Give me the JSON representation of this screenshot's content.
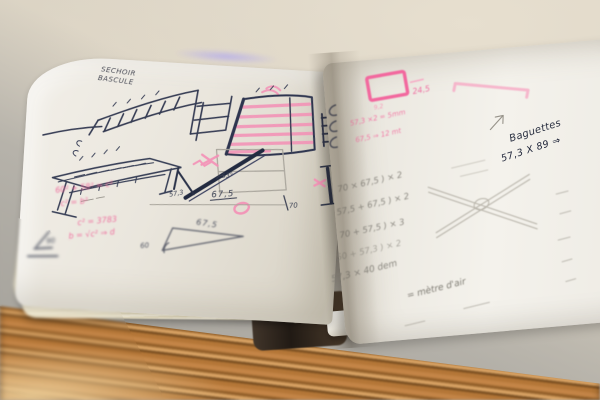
{
  "scene": {
    "subject": "Open sketchbook with hand-drawn drying-rack furniture sketches, pink and pencil measurements, lying on a stone table with a plywood edge"
  },
  "left_page": {
    "title_lines": [
      "SECHOIR",
      "BASCULE"
    ],
    "labels": {
      "beam_angle": "53°",
      "beam_side": "57,3",
      "beam_width": "67,5",
      "panel_height": "70",
      "quad_width": "67,5",
      "quad_height": "60",
      "corner_angle": "90"
    },
    "pink_formulas": [
      "60² + 58² = c²",
      "c² = b²",
      "c² = 3783",
      "b = √c² ⇒ d"
    ]
  },
  "right_page": {
    "pink_rect_label": "24,5",
    "pink_note": "9,2",
    "pink_lines": [
      "57,3 ×2 = 5mm",
      "67,5 ⇒ 12 mt"
    ],
    "ink_heading": "Baguettes",
    "ink_formula": "57,3 X 89 ⇒",
    "pencil_calcs": [
      "70 × 67,5 ) × 2",
      "57,5 + 67,5 ) × 2",
      "70 + 57,5 ) × 3",
      "50 + 57,3 ) × 2",
      "57,3 × 40 dem",
      "= mètre d'air"
    ]
  },
  "colors": {
    "ink": "#343b52",
    "pencil": "#8b8880",
    "pink": "#f2679e",
    "paper": "#efece5",
    "wood": "#a06a32",
    "table": "#d8d0c1",
    "marble": "#a7a49d"
  }
}
